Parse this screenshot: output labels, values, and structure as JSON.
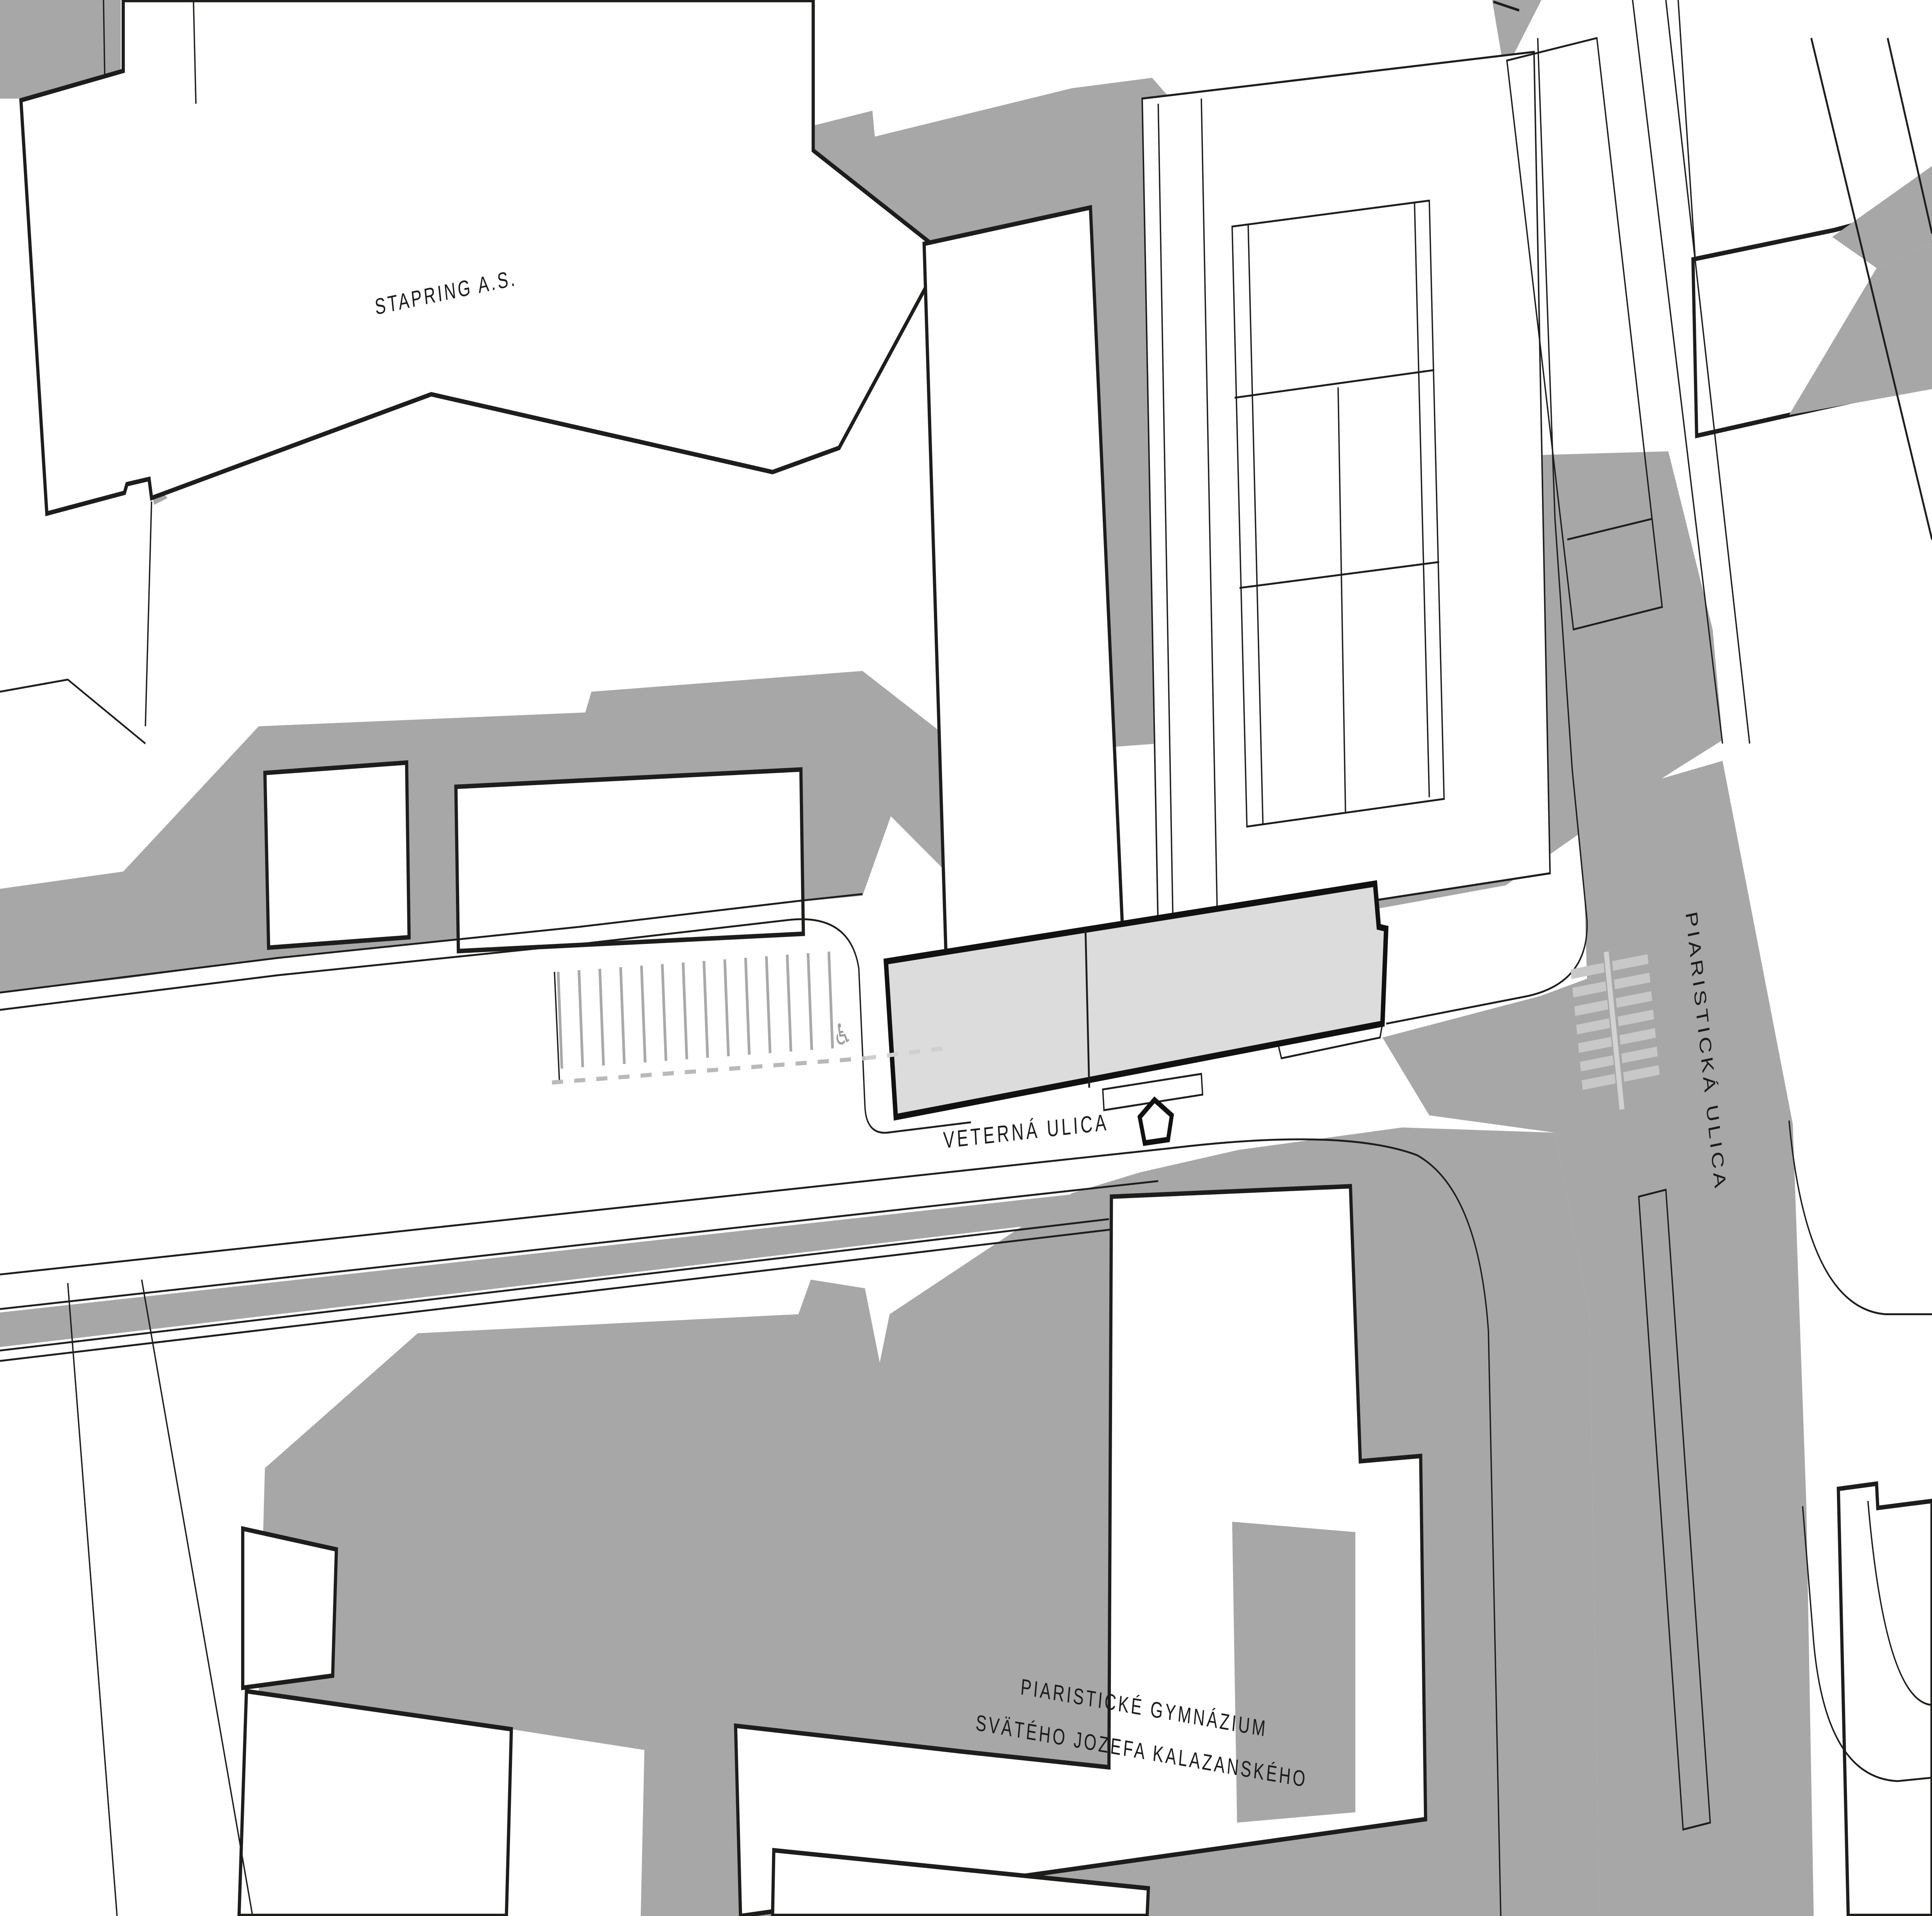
{
  "map": {
    "type": "architectural-site-plan",
    "labels": {
      "stapring": "STAPRING A.S.",
      "veterna": "VETERNÁ ULICA",
      "piaristicka": "PIARISTICKÁ ULICA",
      "gym_line1": "PIARISTICKÉ GYMNÁZIUM",
      "gym_line2": "SVÄTÉHO JOZEFA KALAZANSKÉHO"
    },
    "icons": {
      "wheelchair": "♿",
      "wheelchair_meaning": "accessible-parking-space",
      "entrance_arrow_meaning": "building-entrance-direction"
    },
    "colors": {
      "background": "#ffffff",
      "shadow_gray": "#a7a7a7",
      "highlight_building_fill": "#dcdcdc",
      "outline_black": "#1d1d1b",
      "road_marking_gray": "#b9b9b9",
      "crosswalk_stripe": "#c8c8c8"
    }
  }
}
